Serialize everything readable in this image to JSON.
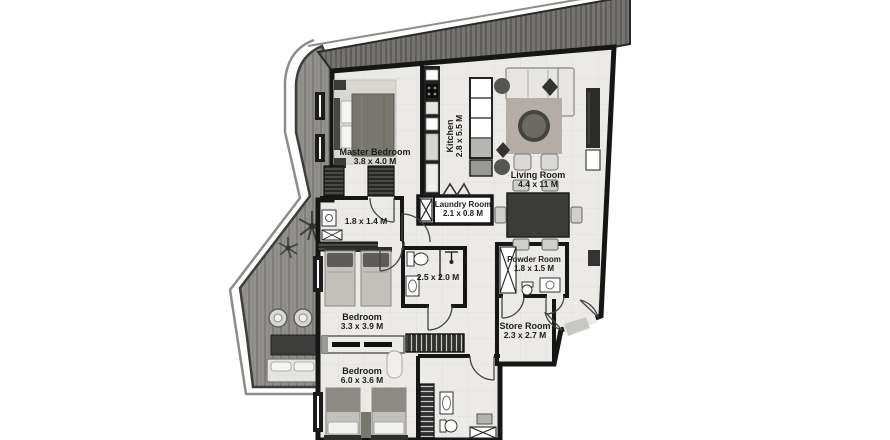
{
  "plan": {
    "type": "apartment-floor-plan",
    "units": "M",
    "rooms": [
      {
        "id": "master-bedroom",
        "name": "Master Bedroom",
        "dims": "3.8 x 4.0 M"
      },
      {
        "id": "kitchen",
        "name": "Kitchen",
        "dims": "2.8 x 5.5 M"
      },
      {
        "id": "living-room",
        "name": "Living Room",
        "dims": "4.4 x 11 M"
      },
      {
        "id": "laundry-room",
        "name": "Laundry Room",
        "dims": "2.1 x 0.8 M"
      },
      {
        "id": "master-bathroom",
        "name": "",
        "dims": "1.8 x 1.4 M"
      },
      {
        "id": "bathroom",
        "name": "",
        "dims": "2.5 x 2.0 M"
      },
      {
        "id": "powder-room",
        "name": "Powder Room",
        "dims": "1.8 x 1.5 M"
      },
      {
        "id": "bedroom-2",
        "name": "Bedroom",
        "dims": "3.3 x 3.9 M"
      },
      {
        "id": "store-room",
        "name": "Store Room",
        "dims": "2.3 x 2.7 M"
      },
      {
        "id": "bedroom-3",
        "name": "Bedroom",
        "dims": "6.0 x 3.6 M"
      }
    ],
    "icons": [
      "double-bed-icon",
      "single-bed-icon",
      "sofa-icon",
      "armchair-icon",
      "round-coffee-table-icon",
      "dining-table-icon",
      "dining-chair-icon",
      "kitchen-counter-icon",
      "kitchen-island-icon",
      "washing-machine-icon",
      "toilet-icon",
      "sink-icon",
      "shower-icon",
      "wardrobe-icon",
      "tv-console-icon",
      "palm-plant-icon",
      "plant-icon",
      "door-arc-icon",
      "entry-double-door-icon",
      "outdoor-chair-icon",
      "outdoor-sofa-icon",
      "outdoor-table-icon",
      "shelf-unit-icon"
    ],
    "colors": {
      "wall": "#161616",
      "floor": "#ebeae7",
      "deck": "#93918d",
      "balcony_band": "#757471",
      "furniture_dark": "#3b3b39",
      "paper": "#ffffff"
    }
  }
}
